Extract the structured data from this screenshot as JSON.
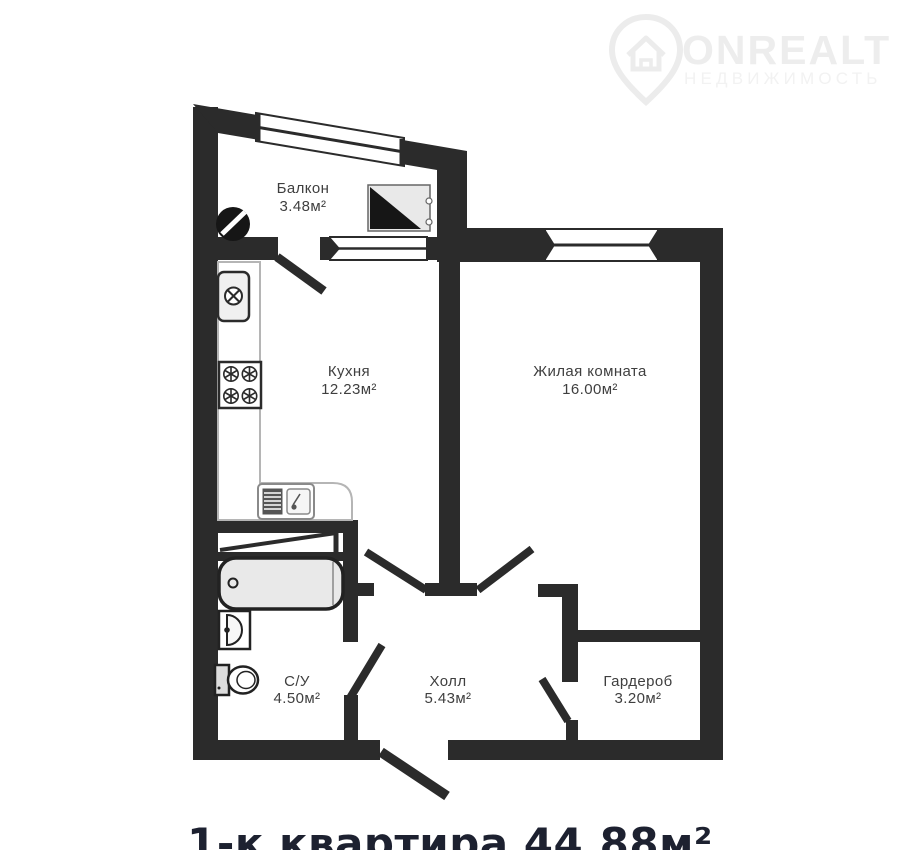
{
  "watermark": {
    "brand": "ONREALT",
    "subtitle": "НЕДВИЖИМОСТЬ"
  },
  "title": "1-к квартира 44.88м²",
  "rooms": {
    "balcony": {
      "name": "Балкон",
      "area": "3.48м²"
    },
    "kitchen": {
      "name": "Кухня",
      "area": "12.23м²"
    },
    "living": {
      "name": "Жилая комната",
      "area": "16.00м²"
    },
    "bathroom": {
      "name": "С/У",
      "area": "4.50м²"
    },
    "hall": {
      "name": "Холл",
      "area": "5.43м²"
    },
    "wardrobe": {
      "name": "Гардероб",
      "area": "3.20м²"
    }
  },
  "colors": {
    "wall": "#2b2b2b",
    "background": "#ffffff",
    "fixture_fill": "#e9e9e9",
    "fixture_stroke": "#222222",
    "counter_stroke": "#b5b5b5",
    "label": "#3f3f3f",
    "title": "#1d2130",
    "watermark": "#ededed"
  }
}
